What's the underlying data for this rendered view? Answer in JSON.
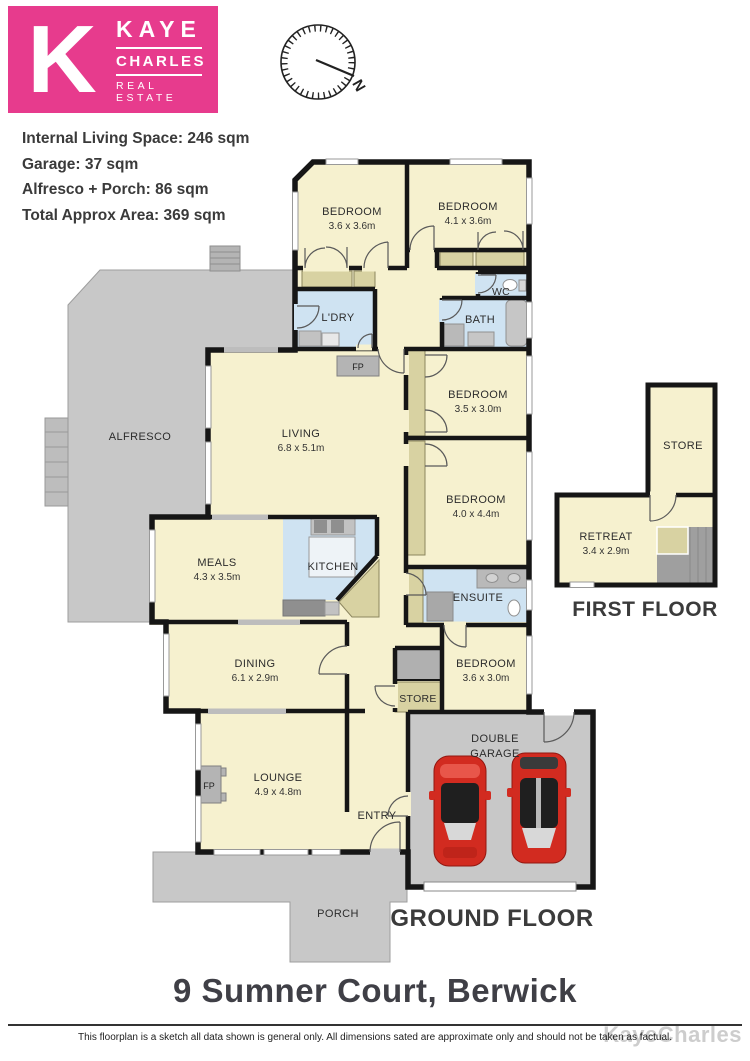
{
  "brand": {
    "k": "K",
    "name_top": "KAYE",
    "name_mid": "CHARLES",
    "name_bottom": "REAL ESTATE",
    "pink": "#e73b8d"
  },
  "compass": {
    "north": "N"
  },
  "stats": {
    "line1": "Internal Living Space: 246 sqm",
    "line2": "Garage: 37 sqm",
    "line3": "Alfresco + Porch: 86 sqm",
    "line4": "Total Approx Area: 369 sqm"
  },
  "rooms": {
    "bedroom1": {
      "name": "BEDROOM",
      "dims": "3.6 x 3.6m"
    },
    "bedroom2": {
      "name": "BEDROOM",
      "dims": "4.1 x 3.6m"
    },
    "bedroom3": {
      "name": "BEDROOM",
      "dims": "3.5 x 3.0m"
    },
    "bedroom4": {
      "name": "BEDROOM",
      "dims": "4.0 x 4.4m"
    },
    "bedroom5": {
      "name": "BEDROOM",
      "dims": "3.6 x 3.0m"
    },
    "living": {
      "name": "LIVING",
      "dims": "6.8 x 5.1m"
    },
    "meals": {
      "name": "MEALS",
      "dims": "4.3 x 3.5m"
    },
    "dining": {
      "name": "DINING",
      "dims": "6.1 x 2.9m"
    },
    "lounge": {
      "name": "LOUNGE",
      "dims": "4.9 x 4.8m"
    },
    "retreat": {
      "name": "RETREAT",
      "dims": "3.4 x 2.9m"
    },
    "kitchen": {
      "name": "KITCHEN"
    },
    "ensuite": {
      "name": "ENSUITE"
    },
    "bath": {
      "name": "BATH"
    },
    "laundry": {
      "name": "L'DRY"
    },
    "wc": {
      "name": "WC"
    },
    "entry": {
      "name": "ENTRY"
    },
    "alfresco": {
      "name": "ALFRESCO"
    },
    "porch": {
      "name": "PORCH"
    },
    "garage": {
      "name": "DOUBLE",
      "name2": "GARAGE"
    },
    "store_ground": {
      "name": "STORE"
    },
    "store_first": {
      "name": "STORE"
    },
    "fireplace": {
      "abbr": "FP"
    }
  },
  "floors": {
    "first": "FIRST FLOOR",
    "ground": "GROUND FLOOR"
  },
  "address": "9 Sumner Court, Berwick",
  "footer": {
    "disclaimer": "This floorplan is a sketch all data shown is general only. All dimensions sated are approximate only and should not be taken as factual.",
    "watermark": "KayeCharles"
  },
  "colors": {
    "brand_pink": "#e73b8d",
    "room_cream": "#f6f1cf",
    "wet_blue": "#cfe3f2",
    "robe_tan": "#d8d2a2",
    "outdoor_gray": "#c8c8c8",
    "wall_black": "#161616",
    "car_red": "#d22b20"
  }
}
